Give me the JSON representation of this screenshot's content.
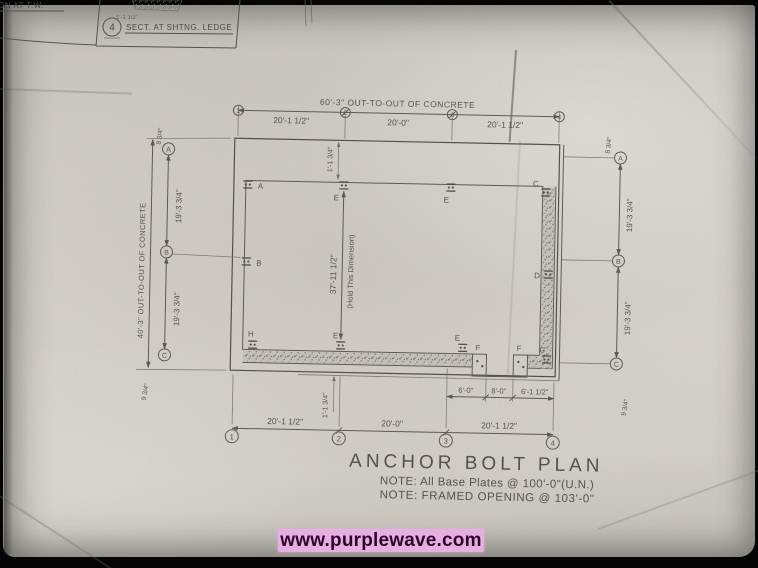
{
  "photo": {
    "watermark_text": "www.purplewave.com",
    "watermark_band_color": "#e7aee2",
    "watermark_text_color": "#2d062a",
    "paper_color": "#d5d2cb"
  },
  "title_block": {
    "detail_bubble": "4",
    "detail_title": "SECT. AT SHTNG. LEDGE",
    "partial_title": "SECTION AT T.W.",
    "lap_note": "1'-1 1/2\""
  },
  "plan": {
    "title": "ANCHOR BOLT PLAN",
    "note1": "NOTE: All Base Plates @ 100'-0\"(U.N.)",
    "note2": "NOTE: FRAMED OPENING @ 103'-0\"",
    "grid": {
      "cols": [
        "1",
        "2",
        "3",
        "4"
      ],
      "rows": [
        "A",
        "B",
        "C"
      ]
    },
    "dims": {
      "top_overall": "60'-3\" OUT-TO-OUT OF CONCRETE",
      "bay1": "20'-1 1/2\"",
      "bay2": "20'-0\"",
      "bay3": "20'-1 1/2\"",
      "left_overall": "40'-3\" OUT-TO-OUT OF CONCRETE",
      "row_seg": "19'-3 3/4\"",
      "interior": "37'-11 1/2\"",
      "interior_note": "(Hold This Dimension)",
      "open1": "6'-0\"",
      "open2": "8'-0\"",
      "open3": "6'-1 1/2\"",
      "off_top": "8 3/4\"",
      "off_bottom": "9 3/4\"",
      "corner": "1'-1 3/4\""
    },
    "bolts": {
      "a": "A",
      "b": "B",
      "c": "C",
      "d": "D",
      "e": "E",
      "f": "F",
      "g": "G",
      "h": "H"
    }
  }
}
